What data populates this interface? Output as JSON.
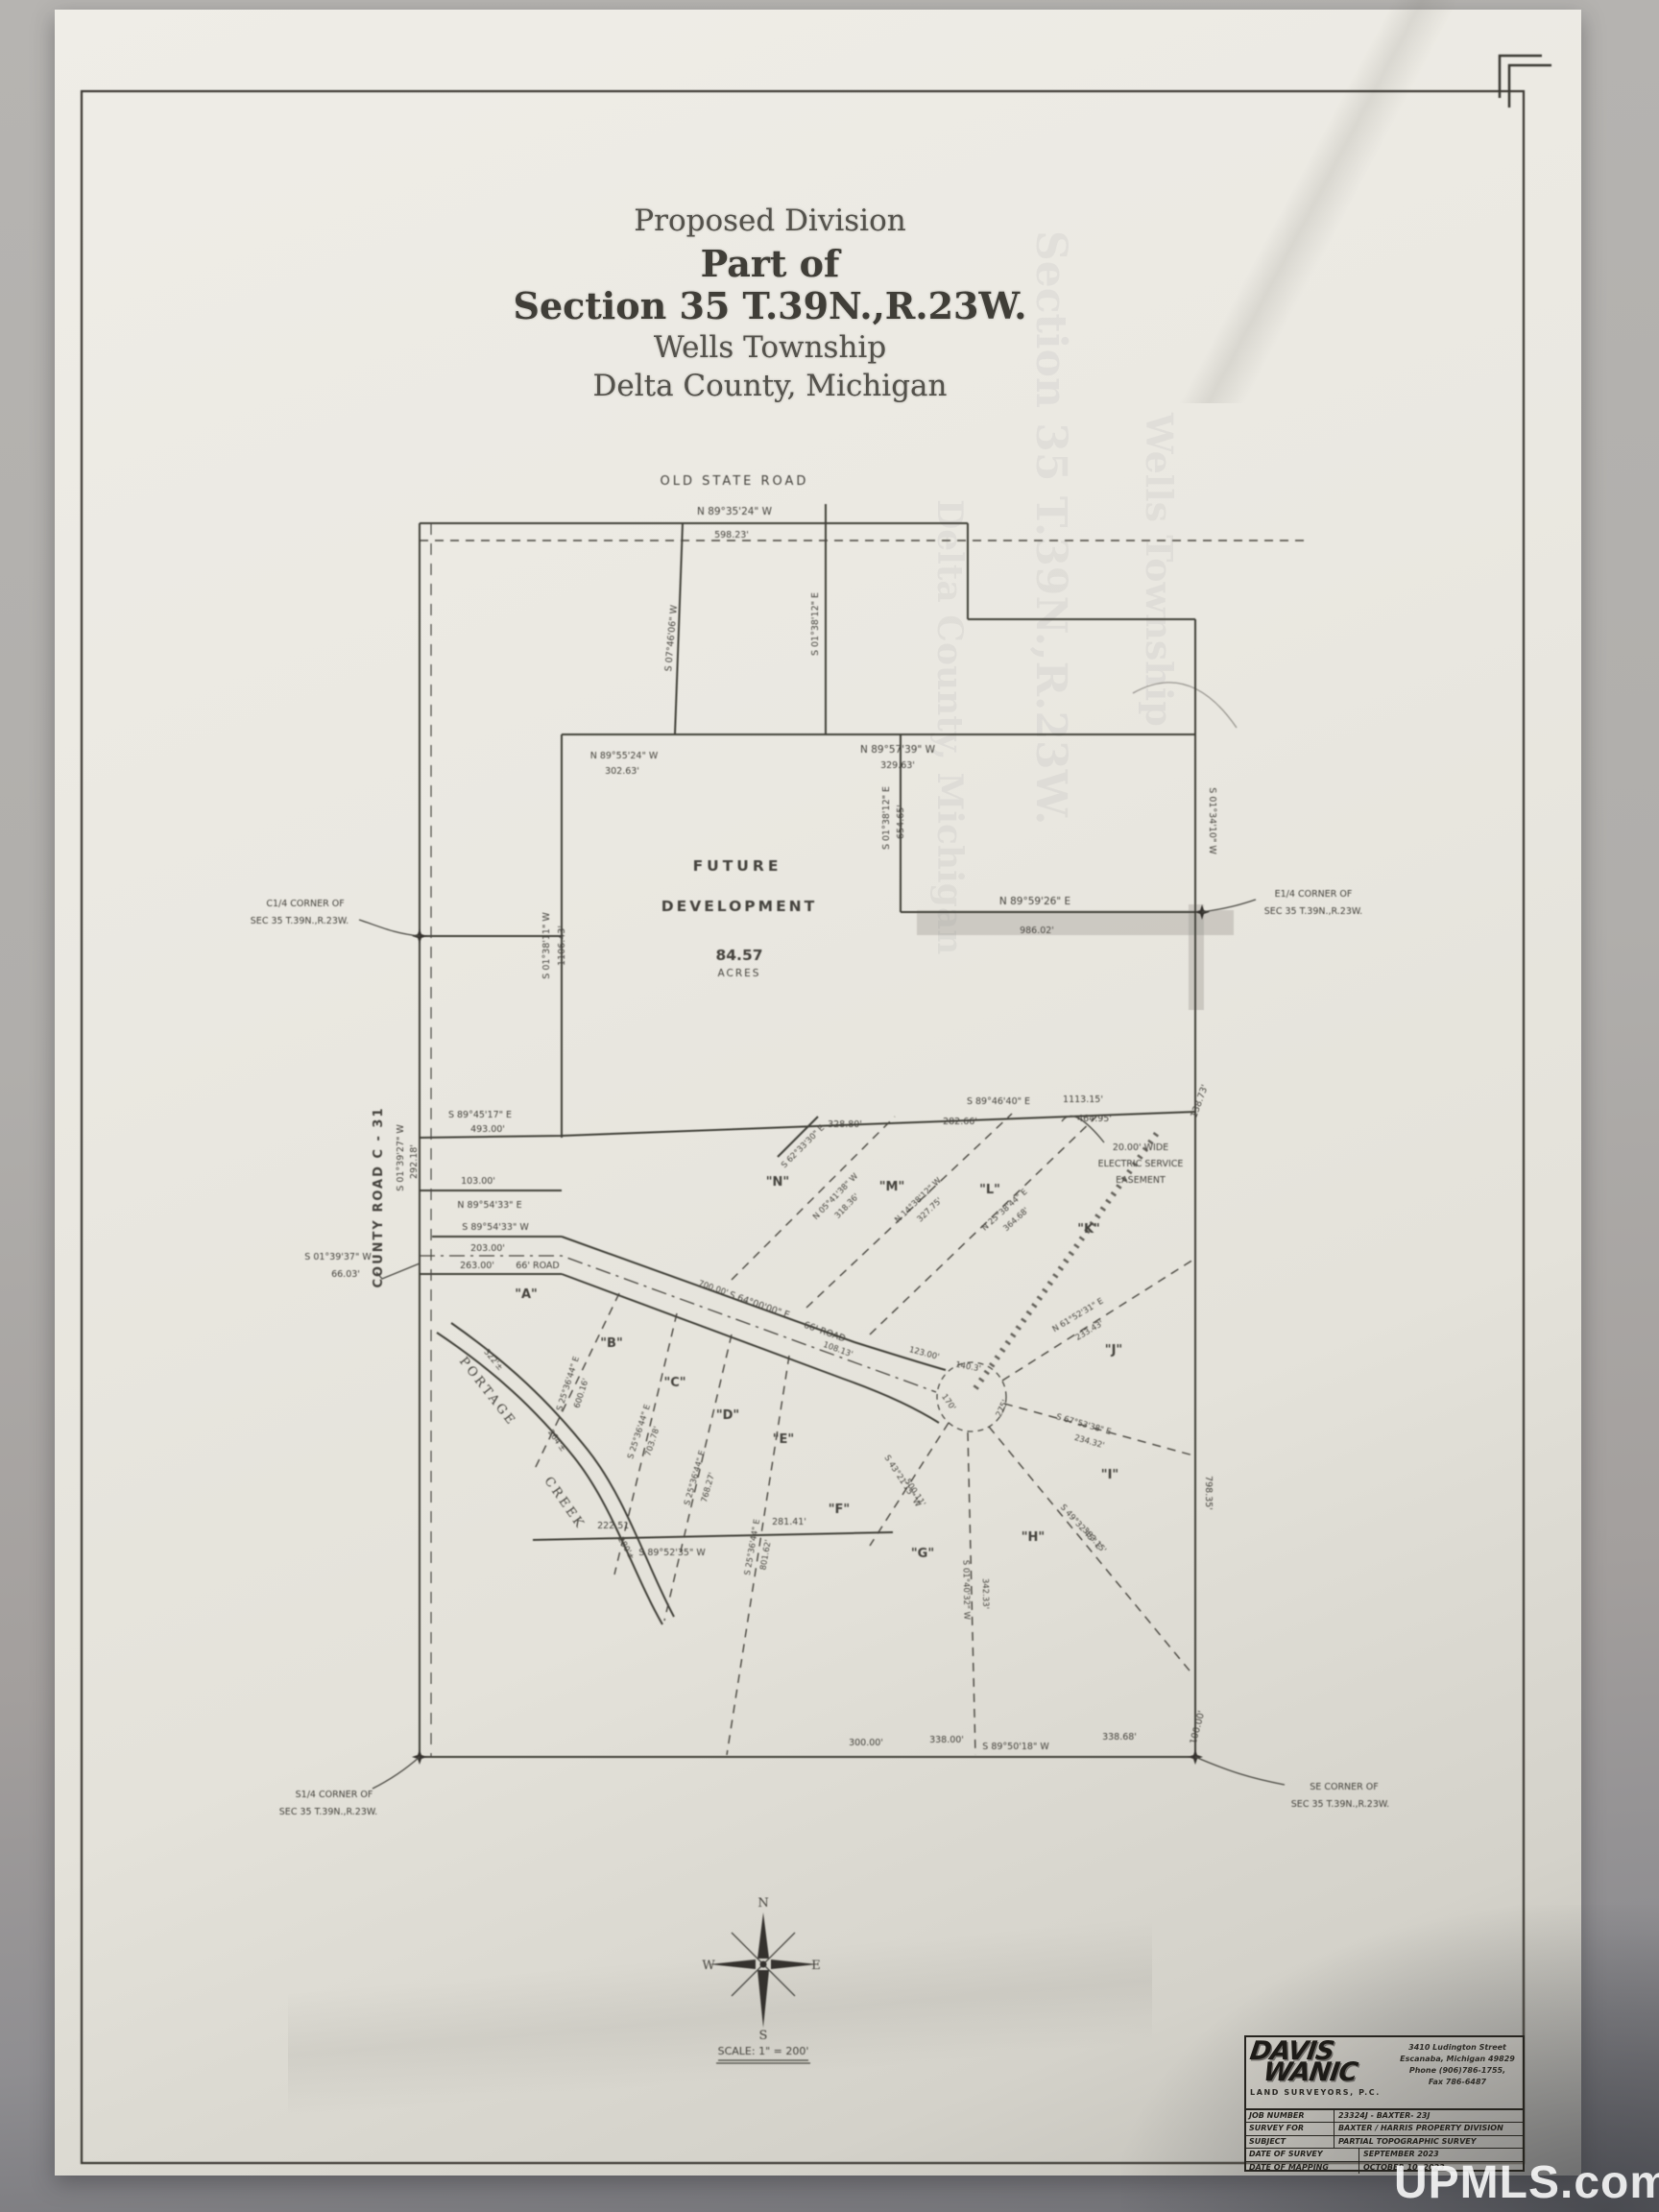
{
  "title": {
    "line1": "Proposed Division",
    "line2": "Part of",
    "line3": "Section 35 T.39N.,R.23W.",
    "line4": "Wells Township",
    "line5": "Delta County, Michigan"
  },
  "map": {
    "road_top": "OLD STATE ROAD",
    "road_left": "COUNTY ROAD C - 31",
    "future": {
      "l1": "FUTURE",
      "l2": "DEVELOPMENT",
      "acres_value": "84.57",
      "acres_word": "ACRES"
    },
    "creek": {
      "word1": "PORTAGE",
      "word2": "CREEK"
    },
    "easement": {
      "l1": "20.00' WIDE",
      "l2": "ELECTRIC SERVICE",
      "l3": "EASEMENT"
    },
    "lot_labels": [
      "\"A\"",
      "\"B\"",
      "\"C\"",
      "\"D\"",
      "\"E\"",
      "\"F\"",
      "\"G\"",
      "\"H\"",
      "\"I\"",
      "\"J\"",
      "\"K\"",
      "\"L\"",
      "\"M\"",
      "\"N\""
    ],
    "corners": {
      "c14": [
        "C1/4 CORNER OF",
        "SEC 35 T.39N.,R.23W."
      ],
      "e14": [
        "E1/4 CORNER OF",
        "SEC 35 T.39N.,R.23W."
      ],
      "s14": [
        "S1/4 CORNER OF",
        "SEC 35 T.39N.,R.23W."
      ],
      "se": [
        "SE CORNER OF",
        "SEC 35 T.39N.,R.23W."
      ]
    },
    "bearings": {
      "osr_b": "N 89°35'24\" W",
      "osr_l": "598.23'",
      "b1": "S 07°46'06\" W",
      "b2a": "N 89°55'24\" W",
      "b2b": "302.63'",
      "b3a": "S 01°38'11\" W",
      "b3b": "1106.43'",
      "b4a": "S 01°38'12\" E",
      "b4b": "654.65'",
      "b5a": "N 89°57'39\" W",
      "b5b": "329.63'",
      "b6a": "N 89°59'26\" E",
      "b6b": "986.02'",
      "b7a": "S 01°34'10\" W",
      "b7b": "798.35'",
      "sub_b": "S 89°46'40\" E",
      "sub_l": "1113.15'",
      "seg1": "328.80'",
      "seg2": "282.66'",
      "seg3": "464.95'",
      "seg4": "138.73'",
      "w1": "S 89°45'17\" E",
      "w1l": "493.00'",
      "cr_b": "S 01°39'27\" W",
      "cr_l": "292.18'",
      "e1": "103.00'",
      "e2": "N 89°54'33\" E",
      "e3": "S 89°54'33\" W",
      "e4": "203.00'",
      "e5": "263.00'",
      "e6": "66' ROAD",
      "e7": "S 01°39'37\" W",
      "e8": "66.03'",
      "rd_b": "S 64°00'00\" E",
      "rd_n": "66' ROAD",
      "rd1": "700.00'",
      "rd2": "108.13'",
      "rd3": "140.3'",
      "rd4": "275'",
      "rd5": "170'",
      "rd6": "123.00'",
      "bot1": "300.00'",
      "bot2": "338.00'",
      "bot3": "S 89°50'18\" W",
      "bot4": "338.68'",
      "bot5": "100.00'",
      "f1": "222.51'",
      "f2": "281.41'",
      "f3": "S 89°52'35\" W",
      "nw": "S 62°33'30\" E",
      "ck1": "322'±",
      "ck2": "264'±",
      "ck3": "280'±"
    },
    "lotlines": [
      {
        "b": "S 25°36'44\" E",
        "l": "600.16'"
      },
      {
        "b": "S 25°36'44\" E",
        "l": "703.78'"
      },
      {
        "b": "S 25°36'44\" E",
        "l": "768.27'"
      },
      {
        "b": "S 25°36'44\" E",
        "l": "801.62'"
      },
      {
        "b": "S 43°21'15\" W",
        "l": "500.11'"
      },
      {
        "b": "S 01°40'32\" W",
        "l": "342.33'"
      },
      {
        "b": "S 49°32'45\" E",
        "l": "383.15'"
      },
      {
        "b": "S 67°53'38\" E",
        "l": "234.32'"
      },
      {
        "b": "N 61°52'31\" E",
        "l": "233.43'"
      },
      {
        "b": "N 05°41'38\" W",
        "l": "318.36'"
      },
      {
        "b": "N 14°38'12\" W",
        "l": "327.75'"
      },
      {
        "b": "N 25°38'44\" E",
        "l": "364.68'"
      }
    ],
    "compass": {
      "n": "N",
      "e": "E",
      "s": "S",
      "w": "W",
      "scale": "SCALE: 1\" = 200'"
    }
  },
  "surveyor": {
    "logo_line1": "DAVIS",
    "logo_line2": "WANIC",
    "logo_sub": "LAND SURVEYORS, P.C.",
    "address": [
      "3410 Ludington Street",
      "Escanaba, Michigan 49829",
      "Phone (906)786-1755,",
      "Fax 786-6487"
    ],
    "rows": [
      {
        "label": "JOB NUMBER",
        "value": "23324J - BAXTER- 23J"
      },
      {
        "label": "SURVEY FOR",
        "value": "BAXTER / HARRIS PROPERTY DIVISION"
      },
      {
        "label": "SUBJECT",
        "value": "PARTIAL TOPOGRAPHIC SURVEY"
      },
      {
        "label": "DATE OF SURVEY",
        "value": "SEPTEMBER 2023"
      },
      {
        "label": "DATE OF MAPPING",
        "value": "OCTOBER 10, 2023"
      }
    ]
  },
  "watermark": "UPMLS.com"
}
